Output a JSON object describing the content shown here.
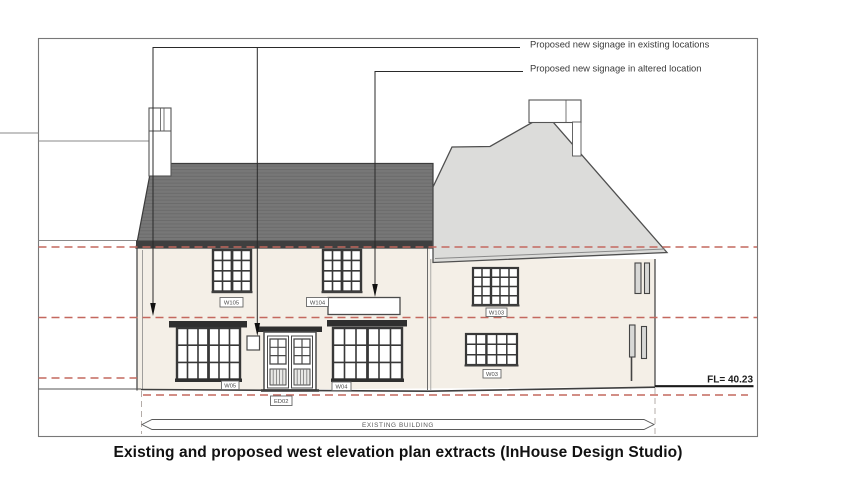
{
  "caption": "Existing and proposed west elevation plan extracts (InHouse Design Studio)",
  "legend": {
    "existing_locations": "Proposed new signage in existing locations",
    "altered_location": "Proposed new signage in altered location"
  },
  "levels": {
    "fl": "FL= 40.23"
  },
  "dimension": {
    "existing_building": "EXISTING BUILDING"
  },
  "labels": {
    "w105": "W105",
    "w104": "W104",
    "w103": "W103",
    "w05": "W05",
    "w04": "W04",
    "w03": "W03",
    "ed02": "ED02"
  },
  "colors": {
    "red_dash": "#c4685f",
    "roof_dark": "#777777",
    "roof_fascia": "#3f3f3f",
    "roof_light": "#dcdcda",
    "wall": "#f4efe7",
    "line": "#4a4a4a"
  }
}
